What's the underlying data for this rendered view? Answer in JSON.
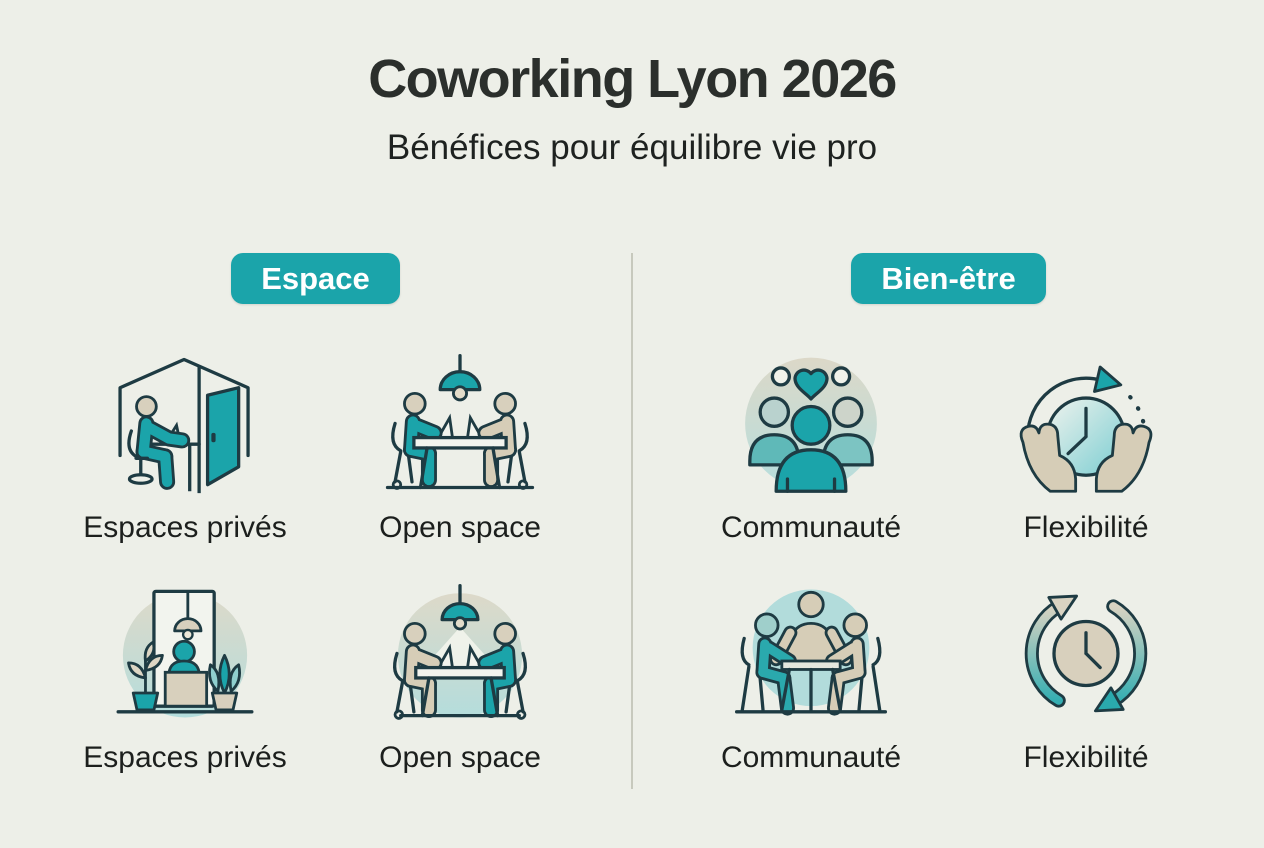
{
  "header": {
    "title": "Coworking Lyon 2026",
    "subtitle": "Bénéfices pour équilibre vie pro"
  },
  "sections": [
    {
      "badge": "Espace",
      "items": [
        {
          "label": "Espaces privés",
          "icon": "private-booth-icon"
        },
        {
          "label": "Open space",
          "icon": "open-space-desks-icon"
        },
        {
          "label": "Espaces privés",
          "icon": "reception-booth-icon"
        },
        {
          "label": "Open space",
          "icon": "open-space-lamp-icon"
        }
      ]
    },
    {
      "badge": "Bien-être",
      "items": [
        {
          "label": "Communauté",
          "icon": "community-people-icon"
        },
        {
          "label": "Flexibilité",
          "icon": "hands-clock-icon"
        },
        {
          "label": "Communauté",
          "icon": "community-table-icon"
        },
        {
          "label": "Flexibilité",
          "icon": "clock-arrows-icon"
        }
      ]
    }
  ],
  "colors": {
    "background": "#edefe8",
    "accent_teal": "#1ba4aa",
    "outline_dark": "#1e3b43",
    "beige": "#d6cdb7",
    "light_teal": "#b4dddc",
    "badge_text": "#ffffff",
    "text": "#1c1f1d",
    "divider": "#c7c9bd"
  }
}
